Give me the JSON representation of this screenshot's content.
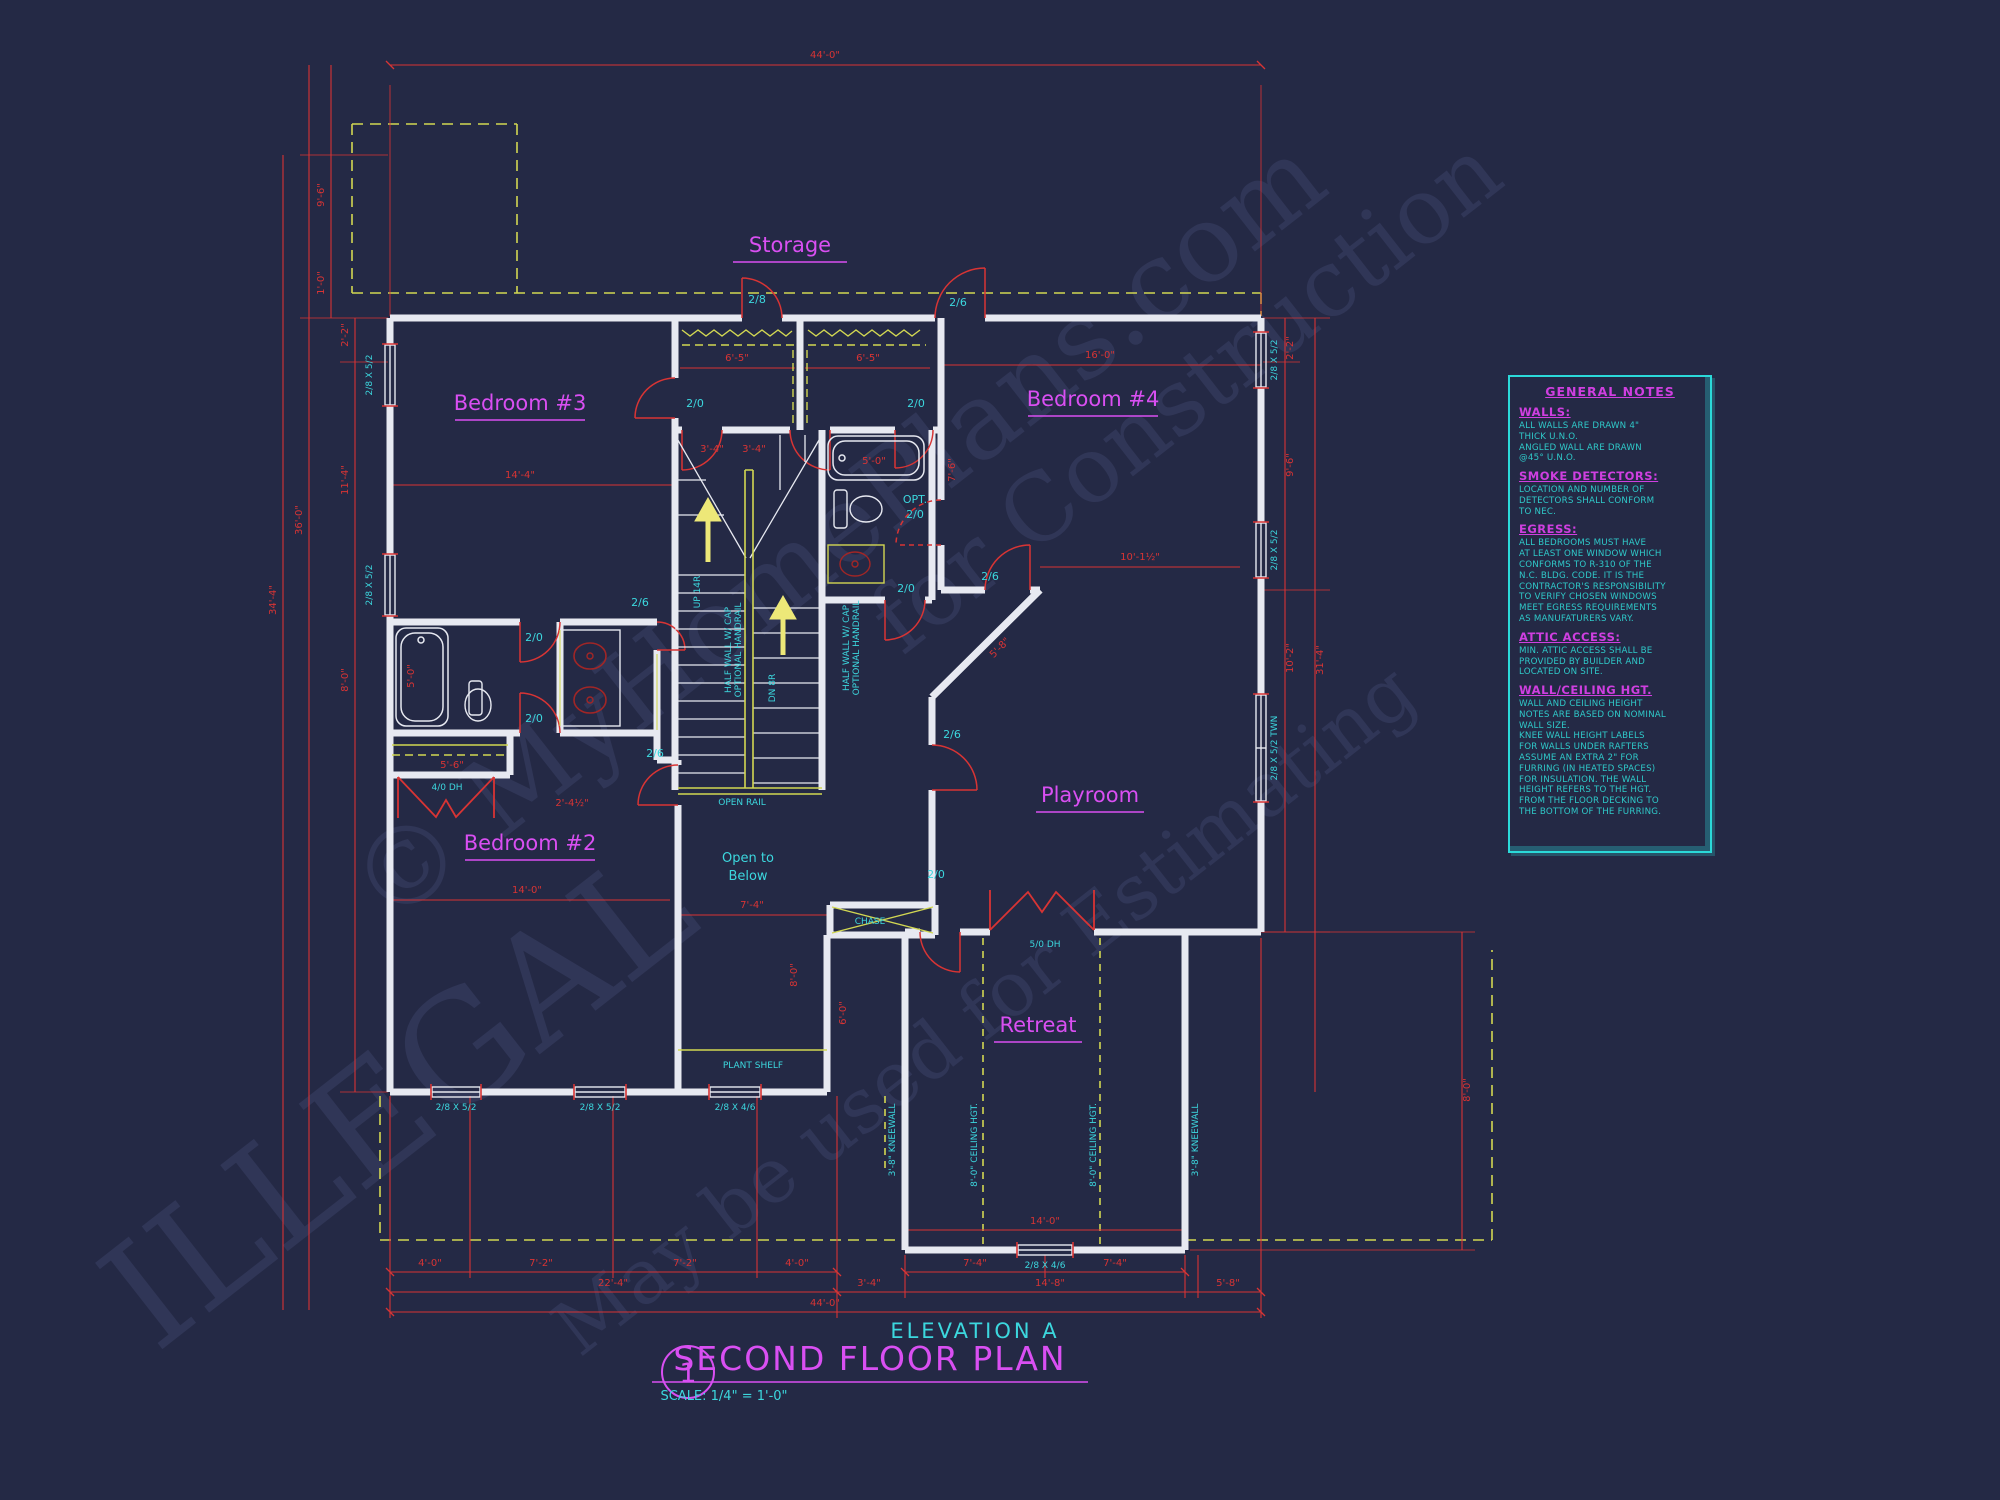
{
  "colors": {
    "background": "#242945",
    "walls": "#e7e9f1",
    "dimension_red": "#d83434",
    "label_cyan": "#3cd7de",
    "label_magenta": "#d94ff2",
    "shelf_yellow": "#d2d752",
    "notes_cyan": "#2bd9d9"
  },
  "watermarks": [
    "© MyHomePlans.com",
    "ILLEGAL",
    "May be used for Estimating",
    "for Construction"
  ],
  "rooms": {
    "storage": "Storage",
    "bedroom3": "Bedroom #3",
    "bedroom4": "Bedroom #4",
    "bedroom2": "Bedroom #2",
    "playroom": "Playroom",
    "retreat": "Retreat"
  },
  "openings": {
    "d2_0": "2/0",
    "d2_6": "2/6",
    "d2_8": "2/8",
    "w2852": "2/8 X 5/2",
    "w2846": "2/8 X 4/6",
    "w2852t": "2/8 X 5/2 TWN",
    "w40dh": "4/0 DH",
    "w50dh": "5/0 DH"
  },
  "annotations": {
    "open_rail": "OPEN RAIL",
    "open_below_1": "Open to",
    "open_below_2": "Below",
    "plant_shelf": "PLANT SHELF",
    "chase": "CHASE",
    "kneewall": "3'-8\" KNEEWALL",
    "ceiling_hgt": "8'-0\" CEILING HGT.",
    "half_wall_1": "HALF WALL W/ CAP",
    "half_wall_2": "OPTIONAL HANDRAIL",
    "up": "UP 14R",
    "dn": "DN 8R",
    "opt": "OPT."
  },
  "dims": {
    "d44": "44'-0\"",
    "d22_4": "22'-4\"",
    "d4_0": "4'-0\"",
    "d7_2": "7'-2\"",
    "d7_4": "7'-4\"",
    "d14_8": "14'-8\"",
    "d3_4": "3'-4\"",
    "d5_8": "5'-8\"",
    "d14_0": "14'-0\"",
    "d14_4": "14'-4\"",
    "d16_0": "16'-0\"",
    "d6_5": "6'-5\"",
    "d5_0": "5'-0\"",
    "d10_1h": "10'-1½\"",
    "d2_2": "2'-2\"",
    "d9_6": "9'-6\"",
    "d1_0": "1'-0\"",
    "d11_4": "11'-4\"",
    "d36_0": "36'-0\"",
    "d34_4": "34'-4\"",
    "d10_2": "10'-2\"",
    "d31_4": "31'-4\"",
    "d8_0": "8'-0\"",
    "d6_0": "6'-0\"",
    "d7_6": "7'-6\"",
    "d2_4h": "2'-4½\"",
    "d5_6": "5'-6\""
  },
  "general_notes": {
    "title": "GENERAL NOTES",
    "sections": [
      {
        "heading": "WALLS:",
        "body": "ALL WALLS ARE DRAWN 4\"\nTHICK U.N.O.\nANGLED WALL ARE DRAWN\n@45° U.N.O."
      },
      {
        "heading": "SMOKE DETECTORS:",
        "body": "LOCATION AND NUMBER OF\nDETECTORS SHALL CONFORM\nTO NEC."
      },
      {
        "heading": "EGRESS:",
        "body": "ALL BEDROOMS MUST HAVE\nAT LEAST ONE WINDOW WHICH\nCONFORMS TO R-310 OF THE\nN.C. BLDG. CODE. IT IS THE\nCONTRACTOR'S RESPONSIBILITY\nTO VERIFY CHOSEN WINDOWS\nMEET EGRESS REQUIREMENTS\nAS MANUFATURERS VARY."
      },
      {
        "heading": "ATTIC ACCESS:",
        "body": "MIN. ATTIC ACCESS SHALL BE\nPROVIDED BY BUILDER AND\nLOCATED ON SITE."
      },
      {
        "heading": "WALL/CEILING HGT.",
        "body": "WALL AND CEILING HEIGHT\nNOTES ARE BASED ON NOMINAL\nWALL SIZE.\nKNEE WALL HEIGHT LABELS\nFOR WALLS UNDER RAFTERS\nASSUME AN EXTRA 2\" FOR\nFURRING (IN HEATED SPACES)\nFOR INSULATION. THE WALL\nHEIGHT REFERS TO THE HGT.\nFROM THE FLOOR DECKING TO\nTHE BOTTOM OF THE FURRING."
      }
    ]
  },
  "title_block": {
    "number": "1",
    "elevation": "ELEVATION A",
    "title": "SECOND FLOOR PLAN",
    "scale": "SCALE: 1/4\" = 1'-0\""
  }
}
